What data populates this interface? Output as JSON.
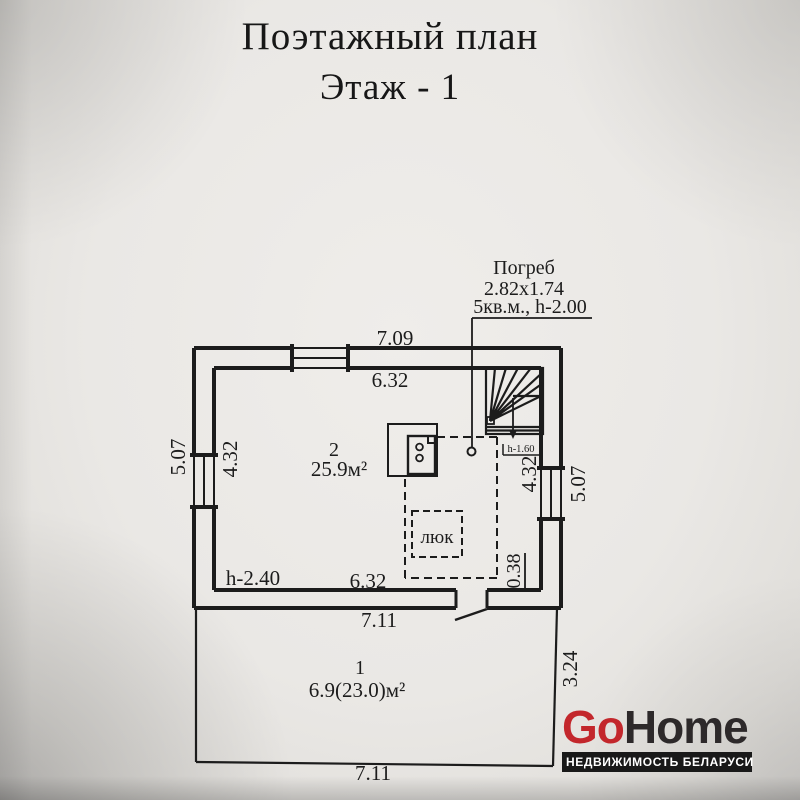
{
  "titles": {
    "line1": "Поэтажный план",
    "line2": "Этаж - 1"
  },
  "cellar_note": {
    "name": "Погреб",
    "size": "2.82x1.74",
    "details": "5кв.м., h-2.00"
  },
  "rooms": {
    "room2": {
      "number": "2",
      "area": "25.9м²",
      "ceiling_height": "h-2.40"
    },
    "room1": {
      "number": "1",
      "area": "6.9(23.0)м²"
    }
  },
  "stairs": {
    "height_label": "h-1.60"
  },
  "hatch": {
    "label": "люк"
  },
  "dims": {
    "top_outer": "7.09",
    "top_inner": "6.32",
    "left_outer": "5.07",
    "left_inner": "4.32",
    "right_inner": "4.32",
    "right_outer": "5.07",
    "bottom_inner": "6.32",
    "door_offset": "0.38",
    "porch_top": "7.11",
    "porch_bottom": "7.11",
    "porch_right": "3.24"
  },
  "logo": {
    "go": "Go",
    "home": "Home",
    "tagline": "НЕДВИЖИМОСТЬ БЕЛАРУСИ",
    "colors": {
      "red": "#c3272c",
      "dark": "#2d292a",
      "bar_bg": "#191919",
      "bar_text": "#ffffff"
    }
  },
  "colors": {
    "ink": "#1c1c1c",
    "paper": "#e9e7e4"
  }
}
